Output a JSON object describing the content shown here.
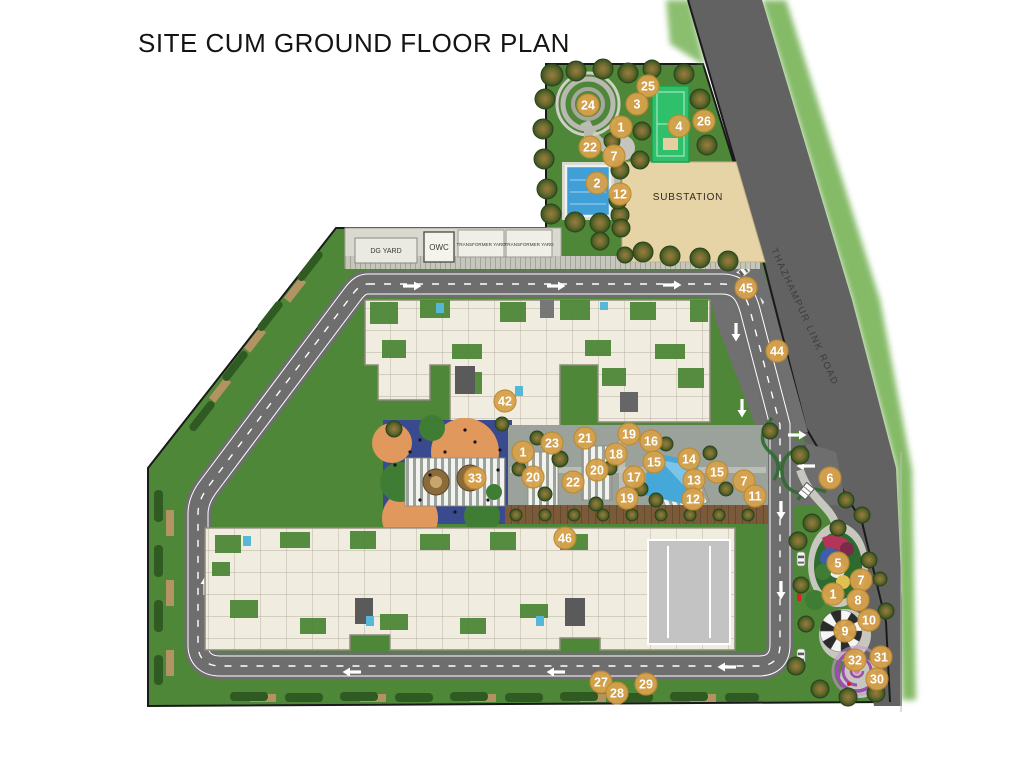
{
  "title": "SITE CUM GROUND FLOOR PLAN",
  "labels": {
    "substation": "SUBSTATION",
    "dg_yard": "DG YARD",
    "owc": "OWC",
    "transformer_yard_1": "TRANSFORMER YARD",
    "transformer_yard_2": "TRANSFORMER YARD",
    "road": "THAZHAMPUR LINK ROAD"
  },
  "colors": {
    "marker_fill": "#d7a24c",
    "marker_rim": "#bd8a33",
    "marker_text": "#ffffff",
    "lawn": "#4e8738",
    "road": "#6e6e6e",
    "main_road": "#626262",
    "building": "#f0ece0",
    "water": "#45a8d8",
    "sport_court": "#2ec06a",
    "substation_fill": "#e7d4a6",
    "play_area": "#3a4a8f",
    "deck": "#7a5a38"
  },
  "markers": [
    {
      "n": 24,
      "x": 588,
      "y": 105
    },
    {
      "n": 25,
      "x": 648,
      "y": 86
    },
    {
      "n": 3,
      "x": 637,
      "y": 104
    },
    {
      "n": 1,
      "x": 621,
      "y": 127
    },
    {
      "n": 4,
      "x": 679,
      "y": 126
    },
    {
      "n": 26,
      "x": 704,
      "y": 121
    },
    {
      "n": 22,
      "x": 590,
      "y": 147
    },
    {
      "n": 7,
      "x": 614,
      "y": 156
    },
    {
      "n": 2,
      "x": 597,
      "y": 183
    },
    {
      "n": 12,
      "x": 620,
      "y": 194
    },
    {
      "n": 45,
      "x": 746,
      "y": 288
    },
    {
      "n": 44,
      "x": 777,
      "y": 351
    },
    {
      "n": 42,
      "x": 505,
      "y": 401
    },
    {
      "n": 1,
      "x": 523,
      "y": 452
    },
    {
      "n": 23,
      "x": 552,
      "y": 443
    },
    {
      "n": 21,
      "x": 585,
      "y": 438
    },
    {
      "n": 19,
      "x": 629,
      "y": 434
    },
    {
      "n": 16,
      "x": 651,
      "y": 441
    },
    {
      "n": 18,
      "x": 616,
      "y": 454
    },
    {
      "n": 20,
      "x": 533,
      "y": 477
    },
    {
      "n": 22,
      "x": 573,
      "y": 482
    },
    {
      "n": 20,
      "x": 597,
      "y": 470
    },
    {
      "n": 17,
      "x": 634,
      "y": 477
    },
    {
      "n": 15,
      "x": 654,
      "y": 462
    },
    {
      "n": 14,
      "x": 689,
      "y": 459
    },
    {
      "n": 13,
      "x": 694,
      "y": 480
    },
    {
      "n": 15,
      "x": 717,
      "y": 472
    },
    {
      "n": 12,
      "x": 693,
      "y": 499
    },
    {
      "n": 19,
      "x": 627,
      "y": 498
    },
    {
      "n": 7,
      "x": 744,
      "y": 481
    },
    {
      "n": 11,
      "x": 755,
      "y": 496
    },
    {
      "n": 33,
      "x": 475,
      "y": 478
    },
    {
      "n": 46,
      "x": 565,
      "y": 538
    },
    {
      "n": 6,
      "x": 830,
      "y": 478
    },
    {
      "n": 5,
      "x": 838,
      "y": 563
    },
    {
      "n": 7,
      "x": 861,
      "y": 580
    },
    {
      "n": 1,
      "x": 833,
      "y": 594
    },
    {
      "n": 8,
      "x": 858,
      "y": 600
    },
    {
      "n": 10,
      "x": 869,
      "y": 620
    },
    {
      "n": 9,
      "x": 845,
      "y": 631
    },
    {
      "n": 32,
      "x": 855,
      "y": 660
    },
    {
      "n": 31,
      "x": 881,
      "y": 657
    },
    {
      "n": 30,
      "x": 877,
      "y": 679
    },
    {
      "n": 27,
      "x": 601,
      "y": 682
    },
    {
      "n": 28,
      "x": 617,
      "y": 693
    },
    {
      "n": 29,
      "x": 646,
      "y": 684
    }
  ]
}
